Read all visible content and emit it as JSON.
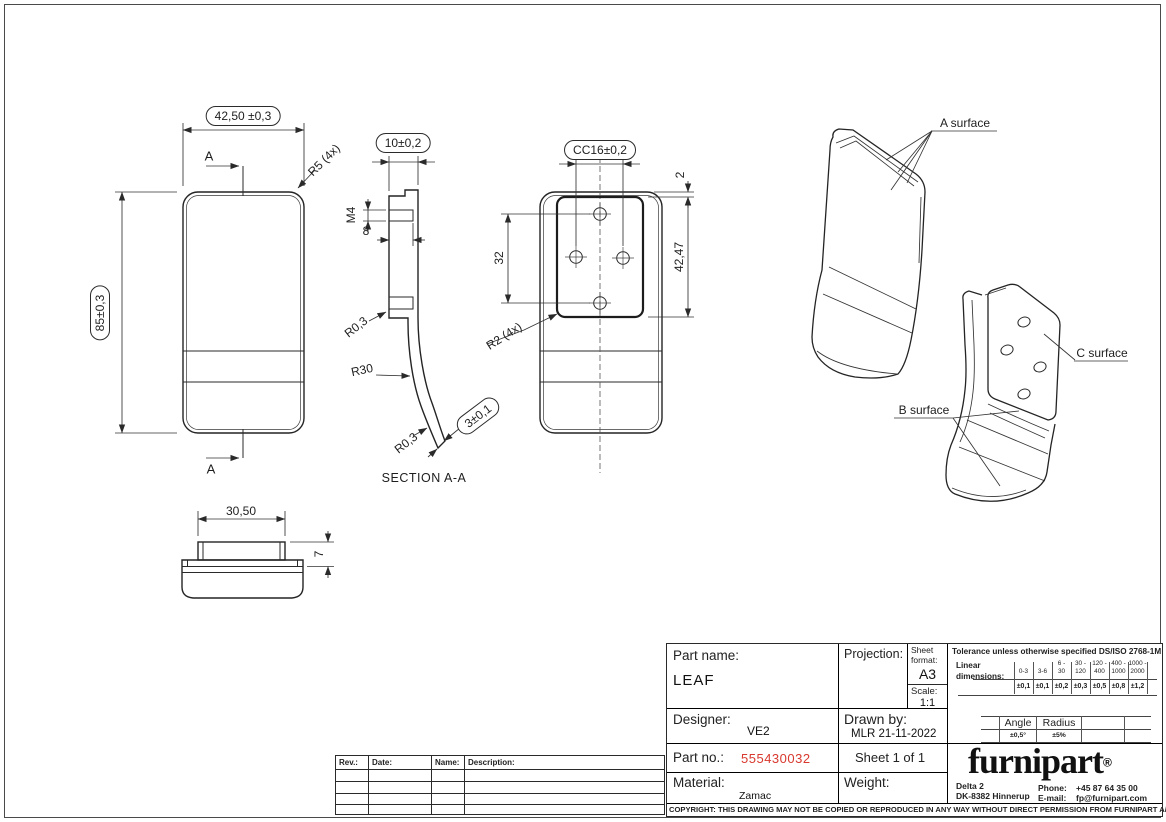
{
  "sheet": {
    "copyright": "COPYRIGHT: THIS DRAWING MAY NOT BE COPIED OR REPRODUCED IN ANY WAY WITHOUT DIRECT PERMISSION FROM FURNIPART A/S"
  },
  "front_view": {
    "width_dim": "42,50 ±0,3",
    "height_dim": "85±0,3",
    "corner_radius": "R5 (4x)",
    "section_arrow_top": "A",
    "section_arrow_bottom": "A"
  },
  "section_view": {
    "title": "SECTION A-A",
    "top_width_dim": "10±0,2",
    "thread_size": "M4",
    "thread_depth_dim": "8",
    "fillet_top": "R0,3",
    "bend_radius": "R30",
    "fillet_bottom": "R0,3",
    "thickness_dim": "3±0,1"
  },
  "back_view": {
    "hole_cc_dim": "CC16±0,2",
    "top_gap_dim": "2",
    "plate_height_dim": "42,47",
    "hole_pitch_dim": "32",
    "plate_corner_radius": "R2 (4x)"
  },
  "bottom_view": {
    "boss_width_dim": "30,50",
    "boss_height_dim": "7"
  },
  "iso_views": {
    "a_surface_label": "A surface",
    "b_surface_label": "B surface",
    "c_surface_label": "C surface"
  },
  "revision_table": {
    "rev_header": "Rev.:",
    "date_header": "Date:",
    "name_header": "Name:",
    "description_header": "Description:"
  },
  "title_block": {
    "part_name_label": "Part name:",
    "part_name": "LEAF",
    "projection_label": "Projection:",
    "sheet_format_label": "Sheet format:",
    "sheet_format": "A3",
    "scale_label": "Scale:",
    "scale": "1:1",
    "designer_label": "Designer:",
    "designer": "VE2",
    "drawn_by_label": "Drawn by:",
    "drawn_by": "MLR 21-11-2022",
    "part_no_label": "Part no.:",
    "part_no": "555430032",
    "part_no_color": "#d8382e",
    "sheet_info": "Sheet 1 of 1",
    "material_label": "Material:",
    "material": "Zamac",
    "weight_label": "Weight:",
    "tolerance": {
      "title": "Tolerance unless otherwise specified DS/ISO 2768-1M",
      "linear_word": "Linear",
      "dimensions_word": "dimensions:",
      "ranges": [
        [
          "",
          "0-3"
        ],
        [
          "",
          "3-6"
        ],
        [
          "6 -",
          "30"
        ],
        [
          "30 -",
          "120"
        ],
        [
          "120 -",
          "400"
        ],
        [
          "400 -",
          "1000"
        ],
        [
          "1000 -",
          "2000"
        ]
      ],
      "values": [
        "±0,1",
        "±0,1",
        "±0,2",
        "±0,3",
        "±0,5",
        "±0,8",
        "±1,2"
      ],
      "angle_header": "Angle",
      "radius_header": "Radius",
      "angle_tolerance": "±0,5°",
      "radius_tolerance": "±5%"
    },
    "brand": {
      "logo_text": "furnipart",
      "registered_mark": "®",
      "address_line1": "Delta 2",
      "address_line2": "DK-8382 Hinnerup",
      "phone_label": "Phone:",
      "phone_number": "+45 87 64 35 00",
      "email_label": "E-mail:",
      "email_address": "fp@furnipart.com"
    }
  }
}
